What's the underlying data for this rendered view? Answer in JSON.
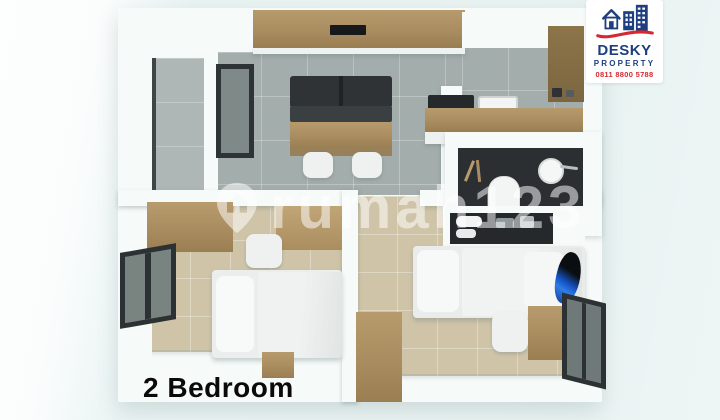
{
  "caption": {
    "text": "2 Bedroom"
  },
  "watermark": {
    "text": "rumah123",
    "icon": "map-pin-house-icon"
  },
  "logo": {
    "brand": "DESKY",
    "subtitle": "PROPERTY",
    "phone": "0811 8800 5788",
    "icon": "house-buildings-icon"
  },
  "palette": {
    "background": "#eaf4f3",
    "wall": "#f6faf9",
    "tile_gray": "#a3adab",
    "tile_beige": "#cfc4a8",
    "wood": "#b79b6d",
    "bathroom_dark_floor": "#2b2f32",
    "sofa_dark": "#33373a",
    "window_frame": "#2c3134",
    "logo_navy": "#1d3f7f",
    "logo_red": "#d7282f",
    "accent_blue_item": "#2e7de8",
    "caption_color": "#0a0a0a",
    "watermark_color": "rgba(255,255,255,0.52)"
  }
}
